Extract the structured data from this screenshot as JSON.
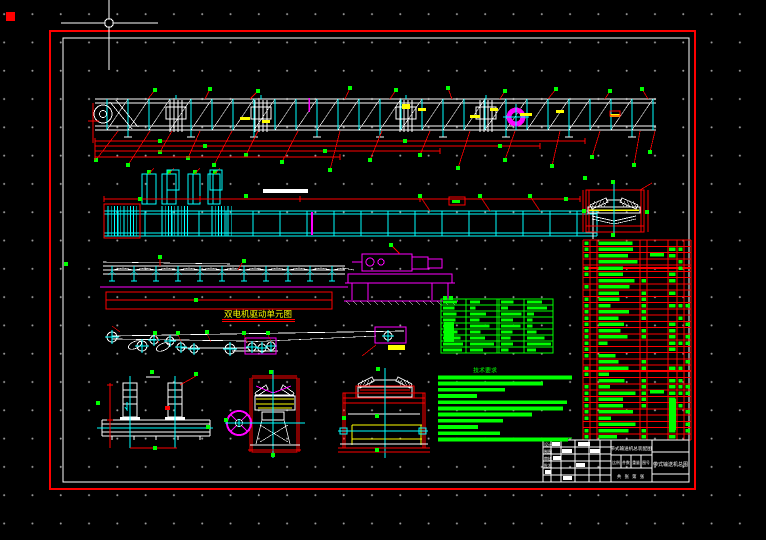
{
  "drawing": {
    "background": "#000000",
    "grid_dot_color": "#9a9a9a",
    "palette": {
      "red": "#ff0000",
      "green": "#00ff00",
      "cyan": "#00ffff",
      "magenta": "#ff00ff",
      "yellow": "#ffff00",
      "white": "#ffffff"
    }
  },
  "captions": {
    "view3_label": "双电机驱动单元图"
  },
  "title_block": {
    "left_labels": [
      "设计",
      "制图",
      "审核",
      "批准"
    ],
    "main_title": "带式输送机总装配图",
    "field_labels": [
      "比例",
      "件数",
      "重量",
      "图号"
    ],
    "sheet_info": "共 张 第 张",
    "drawing_name": "带式输送机总图"
  },
  "bom_table": {
    "visible_rows": 32
  },
  "parameter_table": {
    "visible_rows": 9
  },
  "technical_notes": {
    "heading": "技术要求",
    "line_count": 11
  }
}
